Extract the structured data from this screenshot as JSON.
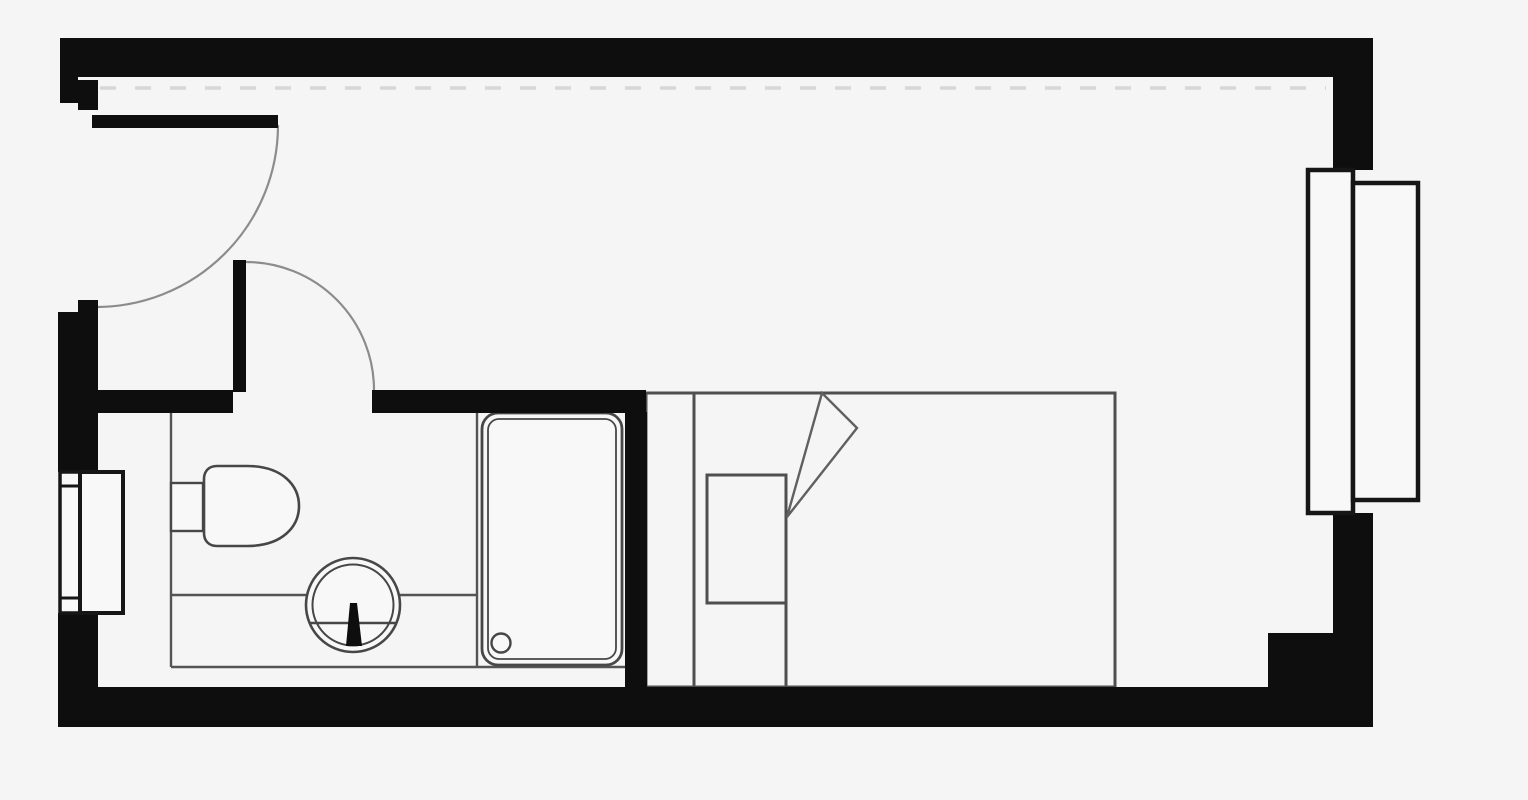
{
  "canvas": {
    "width": 1528,
    "height": 800,
    "background": "#f5f5f6"
  },
  "colors": {
    "wall": "#0e0e0e",
    "window_stroke": "#161616",
    "fixture_stroke": "#474747",
    "partition_stroke": "#545454",
    "furniture_stroke": "#4f4f4f",
    "fold_stroke": "#606060",
    "arc_stroke": "#8c8c8c",
    "fill_light": "#f8f8f9",
    "dashed_line": "#d7d7d7",
    "background": "#f5f5f6"
  },
  "floorplan": {
    "layers": [
      {
        "name": "overhead-annotations",
        "shapes": [
          {
            "name": "ceiling-dashed-line",
            "type": "line",
            "x1": 100,
            "y1": 88,
            "x2": 1326,
            "y2": 88,
            "stroke": "dashed_line",
            "sw": 3.5,
            "dash": "16 19"
          }
        ]
      },
      {
        "name": "door-swings",
        "shapes": [
          {
            "name": "entry-door-swing-arc",
            "type": "path",
            "d": "M 278 125 A 182 182 0 0 1 96 307",
            "stroke": "arc_stroke",
            "sw": 2.2
          },
          {
            "name": "bathroom-door-swing-arc",
            "type": "path",
            "d": "M 246 262 A 128 128 0 0 1 374 390",
            "stroke": "arc_stroke",
            "sw": 2.2
          }
        ]
      },
      {
        "name": "bathroom-partition",
        "shapes": [
          {
            "name": "bathroom-partition-left-line",
            "type": "line",
            "x1": 171,
            "y1": 413,
            "x2": 171,
            "y2": 667,
            "stroke": "partition_stroke",
            "sw": 2.4
          },
          {
            "name": "bathroom-partition-bottom-line",
            "type": "line",
            "x1": 171,
            "y1": 667,
            "x2": 626,
            "y2": 667,
            "stroke": "partition_stroke",
            "sw": 2.4
          },
          {
            "name": "bathroom-counter-line",
            "type": "line",
            "x1": 171,
            "y1": 595,
            "x2": 477,
            "y2": 595,
            "stroke": "partition_stroke",
            "sw": 2.4
          },
          {
            "name": "shower-niche-line",
            "type": "line",
            "x1": 477,
            "y1": 413,
            "x2": 477,
            "y2": 667,
            "stroke": "partition_stroke",
            "sw": 2.4
          }
        ]
      },
      {
        "name": "bathroom-fixtures",
        "shapes": [
          {
            "name": "toilet-cistern",
            "type": "rect",
            "x": 171,
            "y": 483,
            "w": 32,
            "h": 48,
            "fill": "fill_light",
            "stroke": "fixture_stroke",
            "sw": 2.4
          },
          {
            "name": "toilet-bowl",
            "type": "path",
            "d": "M 217 466 H 247 C 283 466 299 486 299 506 C 299 526 283 546 247 546 H 217 C 209 546 204 541 204 533 V 479 C 204 471 209 466 217 466 Z",
            "fill": "fill_light",
            "stroke": "fixture_stroke",
            "sw": 2.6
          },
          {
            "name": "sink-basin-outer",
            "type": "circle",
            "cx": 353,
            "cy": 605,
            "r": 47,
            "fill": "fill_light",
            "stroke": "fixture_stroke",
            "sw": 2.6
          },
          {
            "name": "sink-basin-inner",
            "type": "circle",
            "cx": 353,
            "cy": 605,
            "r": 40.5,
            "stroke": "fixture_stroke",
            "sw": 2
          },
          {
            "name": "sink-waterline",
            "type": "line",
            "x1": 310,
            "y1": 623,
            "x2": 396,
            "y2": 623,
            "stroke": "fixture_stroke",
            "sw": 2.4
          },
          {
            "name": "sink-tap",
            "type": "polygon",
            "points": "350,603 357,603 362,646 346,646",
            "fill": "wall"
          },
          {
            "name": "shower-tray-outer",
            "type": "rect",
            "x": 482,
            "y": 413,
            "w": 140,
            "h": 252,
            "rx": 16,
            "fill": "fill_light",
            "stroke": "fixture_stroke",
            "sw": 2.8
          },
          {
            "name": "shower-tray-inner",
            "type": "rect",
            "x": 488,
            "y": 419,
            "w": 128,
            "h": 240,
            "rx": 11,
            "stroke": "fixture_stroke",
            "sw": 1.8
          },
          {
            "name": "shower-drain",
            "type": "circle",
            "cx": 501,
            "cy": 643,
            "r": 9.5,
            "stroke": "fixture_stroke",
            "sw": 2.4
          }
        ]
      },
      {
        "name": "furniture",
        "shapes": [
          {
            "name": "bed-outline",
            "type": "rect",
            "x": 646,
            "y": 393,
            "w": 469,
            "h": 294,
            "stroke": "furniture_stroke",
            "sw": 3
          },
          {
            "name": "bed-headboard-line",
            "type": "line",
            "x1": 694,
            "y1": 393,
            "x2": 694,
            "y2": 687,
            "stroke": "furniture_stroke",
            "sw": 3
          },
          {
            "name": "bed-pillow",
            "type": "rect",
            "x": 707,
            "y": 475,
            "w": 79,
            "h": 128,
            "stroke": "furniture_stroke",
            "sw": 3
          },
          {
            "name": "bed-duvet-edge-line",
            "type": "line",
            "x1": 786,
            "y1": 475,
            "x2": 786,
            "y2": 687,
            "stroke": "furniture_stroke",
            "sw": 3
          },
          {
            "name": "bed-duvet-fold",
            "type": "polygon",
            "points": "787,517 822,393 857,428",
            "stroke": "fold_stroke",
            "sw": 2.4
          }
        ]
      },
      {
        "name": "walls",
        "shapes": [
          {
            "name": "wall-top",
            "type": "rect",
            "x": 60,
            "y": 38,
            "w": 1313,
            "h": 39,
            "fill": "wall"
          },
          {
            "name": "wall-left-entry-jamb",
            "type": "rect",
            "x": 60,
            "y": 77,
            "w": 18,
            "h": 26,
            "fill": "wall"
          },
          {
            "name": "entry-jamb-step-upper",
            "type": "rect",
            "x": 78,
            "y": 80,
            "w": 20,
            "h": 30,
            "fill": "wall"
          },
          {
            "name": "entry-door-leaf",
            "type": "rect",
            "x": 92,
            "y": 115,
            "w": 186,
            "h": 13,
            "fill": "wall"
          },
          {
            "name": "entry-jamb-step-lower",
            "type": "rect",
            "x": 78,
            "y": 300,
            "w": 20,
            "h": 14,
            "fill": "wall"
          },
          {
            "name": "wall-left-middle",
            "type": "rect",
            "x": 58,
            "y": 312,
            "w": 40,
            "h": 160,
            "fill": "wall"
          },
          {
            "name": "wall-left-lower",
            "type": "rect",
            "x": 58,
            "y": 613,
            "w": 40,
            "h": 114,
            "fill": "wall"
          },
          {
            "name": "wall-bottom",
            "type": "rect",
            "x": 98,
            "y": 687,
            "w": 1275,
            "h": 40,
            "fill": "wall"
          },
          {
            "name": "wall-corner-pier",
            "type": "rect",
            "x": 1268,
            "y": 633,
            "w": 105,
            "h": 56,
            "fill": "wall"
          },
          {
            "name": "wall-right-lower",
            "type": "rect",
            "x": 1333,
            "y": 513,
            "w": 40,
            "h": 175,
            "fill": "wall"
          },
          {
            "name": "wall-right-upper",
            "type": "rect",
            "x": 1333,
            "y": 77,
            "w": 40,
            "h": 93,
            "fill": "wall"
          },
          {
            "name": "bathroom-wall-left-segment",
            "type": "rect",
            "x": 98,
            "y": 390,
            "w": 135,
            "h": 23,
            "fill": "wall"
          },
          {
            "name": "bathroom-door-leaf",
            "type": "rect",
            "x": 233,
            "y": 260,
            "w": 13,
            "h": 132,
            "fill": "wall"
          },
          {
            "name": "bathroom-wall-right-segment",
            "type": "rect",
            "x": 372,
            "y": 390,
            "w": 274,
            "h": 23,
            "fill": "wall"
          },
          {
            "name": "bathroom-wall-vertical",
            "type": "rect",
            "x": 625,
            "y": 412,
            "w": 22,
            "h": 275,
            "fill": "wall"
          }
        ]
      },
      {
        "name": "windows",
        "shapes": [
          {
            "name": "left-window-sill",
            "type": "rect",
            "x": 60,
            "y": 472,
            "w": 20,
            "h": 141,
            "fill": "fill_light",
            "stroke": "window_stroke",
            "sw": 3.5
          },
          {
            "name": "left-window-sill-cap-top",
            "type": "line",
            "x1": 60,
            "y1": 486,
            "x2": 80,
            "y2": 486,
            "stroke": "window_stroke",
            "sw": 3
          },
          {
            "name": "left-window-sill-cap-bottom",
            "type": "line",
            "x1": 60,
            "y1": 598,
            "x2": 80,
            "y2": 598,
            "stroke": "window_stroke",
            "sw": 3
          },
          {
            "name": "left-window-frame",
            "type": "rect",
            "x": 80,
            "y": 472,
            "w": 43,
            "h": 141,
            "fill": "fill_light",
            "stroke": "window_stroke",
            "sw": 4
          },
          {
            "name": "right-window-frame",
            "type": "rect",
            "x": 1308,
            "y": 170,
            "w": 45,
            "h": 343,
            "fill": "fill_light",
            "stroke": "window_stroke",
            "sw": 4.5
          },
          {
            "name": "right-window-sill",
            "type": "rect",
            "x": 1353,
            "y": 183,
            "w": 65,
            "h": 317,
            "fill": "fill_light",
            "stroke": "window_stroke",
            "sw": 4.5
          }
        ]
      }
    ]
  }
}
